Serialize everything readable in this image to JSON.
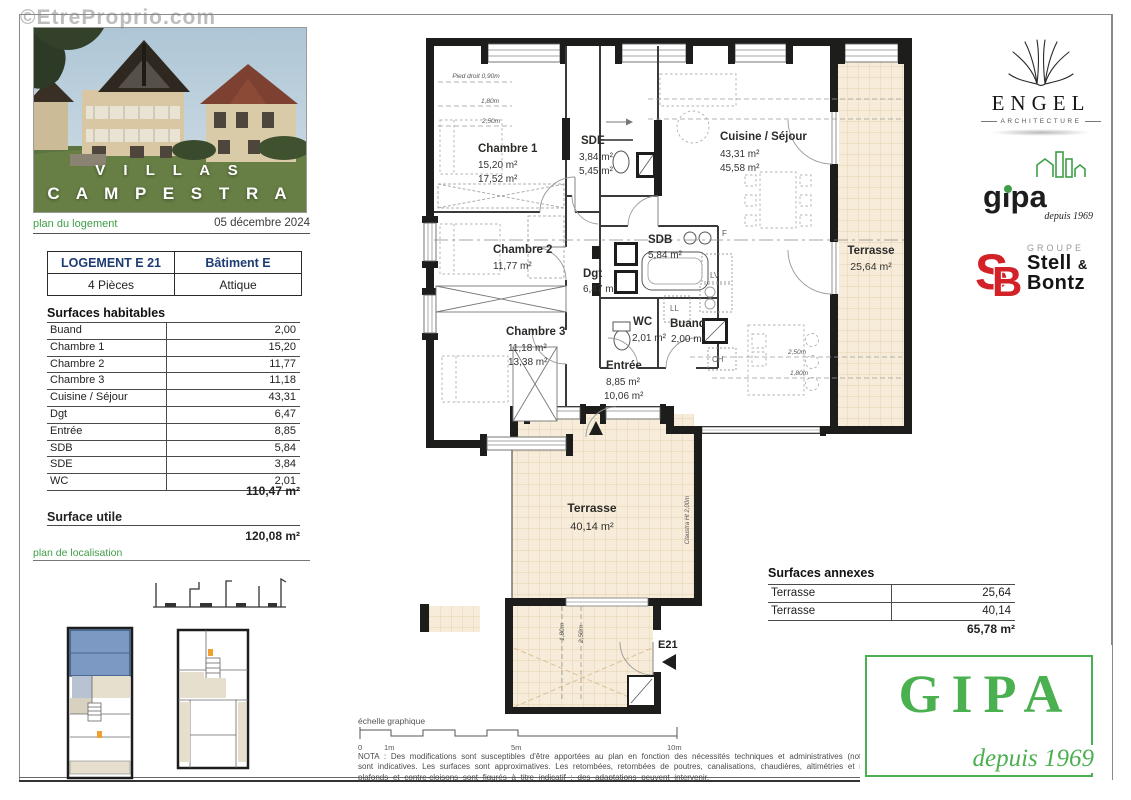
{
  "watermark": "©EtreProprio.com",
  "page": {
    "title1": "V I L L A S",
    "title2": "C A M P E S T R A",
    "plan_label": "plan du logement",
    "date": "05 décembre 2024",
    "unit": {
      "name": "LOGEMENT  E 21",
      "building": "Bâtiment E",
      "rooms": "4 Pièces",
      "level": "Attique"
    },
    "sh": {
      "title": "Surfaces habitables",
      "rows": [
        {
          "label": "Buand",
          "value": "2,00"
        },
        {
          "label": "Chambre 1",
          "value": "15,20"
        },
        {
          "label": "Chambre 2",
          "value": "11,77"
        },
        {
          "label": "Chambre 3",
          "value": "11,18"
        },
        {
          "label": "Cuisine / Séjour",
          "value": "43,31"
        },
        {
          "label": "Dgt",
          "value": "6,47"
        },
        {
          "label": "Entrée",
          "value": "8,85"
        },
        {
          "label": "SDB",
          "value": "5,84"
        },
        {
          "label": "SDE",
          "value": "3,84"
        },
        {
          "label": "WC",
          "value": "2,01"
        }
      ],
      "total": "110,47 m²"
    },
    "su": {
      "title": "Surface utile",
      "value": "120,08 m²"
    },
    "loc_label": "plan de localisation"
  },
  "plan": {
    "rooms": {
      "chambre1": {
        "name": "Chambre 1",
        "a1": "15,20 m²",
        "a2": "17,52 m²"
      },
      "sde": {
        "name": "SDE",
        "a1": "3,84 m²",
        "a2": "5,45 m²"
      },
      "cuisine": {
        "name": "Cuisine / Séjour",
        "a1": "43,31 m²",
        "a2": "45,58 m²"
      },
      "chambre2": {
        "name": "Chambre 2",
        "a1": "11,77 m²"
      },
      "sdb": {
        "name": "SDB",
        "a1": "5,84 m²"
      },
      "dgt": {
        "name": "Dgt",
        "a1": "6,47 m²"
      },
      "chambre3": {
        "name": "Chambre 3",
        "a1": "11,18 m²",
        "a2": "13,38 m²"
      },
      "wc": {
        "name": "WC",
        "a1": "2,01 m²"
      },
      "buand": {
        "name": "Buand",
        "a1": "2,00 m²"
      },
      "entree": {
        "name": "Entrée",
        "a1": "8,85 m²",
        "a2": "10,06 m²"
      },
      "terrasse_est": {
        "name": "Terrasse",
        "a1": "25,64 m²"
      },
      "terrasse_sud": {
        "name": "Terrasse",
        "a1": "40,14 m²"
      }
    },
    "dims": {
      "pied_droit": "Pied droit 0,90m",
      "h180": "1,80m",
      "h250": "2,50m",
      "h250b": "2,50m",
      "h180b": "1,80m",
      "v180": "1,80m",
      "v250": "2,50m",
      "claustra": "Claustra Ht  2,00m",
      "ridge": "F"
    },
    "appliances": {
      "lv": "LV",
      "ll": "LL",
      "ch": "CH"
    },
    "unit_tag": "E21"
  },
  "logos": {
    "engel": {
      "name": "ENGEL",
      "sub": "ARCHITECTURE"
    },
    "gipa_small": {
      "name": "gipa",
      "sub": "depuis 1969"
    },
    "stell": {
      "group": "GROUPE",
      "line1": "Stell",
      "amp": "&",
      "line2": "Bontz"
    },
    "gipa_big": {
      "name": "GIPA",
      "sub": "depuis 1969"
    }
  },
  "annexes": {
    "title": "Surfaces annexes",
    "rows": [
      {
        "label": "Terrasse",
        "value": "25,64"
      },
      {
        "label": "Terrasse",
        "value": "40,14"
      }
    ],
    "total": "65,78 m²"
  },
  "footer": {
    "scale_label": "échelle graphique",
    "ticks": [
      "0",
      "1m",
      "5m",
      "10m"
    ],
    "nota": [
      "NOTA : Des modifications sont susceptibles d'être apportées au plan en fonction des nécessités techniques  et administratives (notamment",
      "sont indicatives. Les surfaces sont approximatives. Les retombées, retombées de poutres, canalisations, chaudières, altimétries et nivellem-",
      "plafonds et contre-cloisons sont figurés à titre indicatif : des adaptations peuvent intervenir."
    ]
  },
  "colors": {
    "green": "#3f9e47",
    "gipa_green": "#4ab050",
    "navy": "#1e3c74",
    "red": "#d22127",
    "wall": "#1d1d1b",
    "terrace": "#f7ecd9"
  }
}
